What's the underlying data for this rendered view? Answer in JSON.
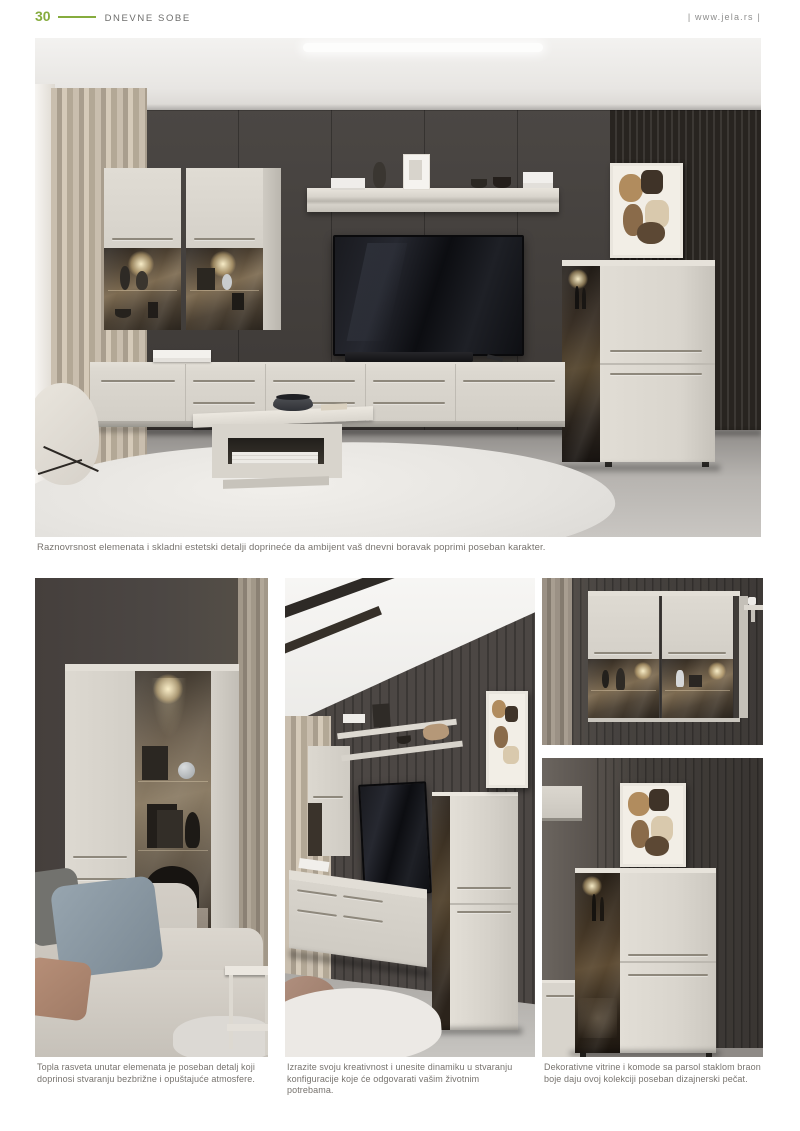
{
  "header": {
    "page_number": "30",
    "section_title": "DNEVNE SOBE",
    "website": "| www.jela.rs |"
  },
  "captions": {
    "main": "Raznovrsnost elemenata i skladni estetski detalji doprineće da ambijent vaš dnevni boravak poprimi poseban karakter.",
    "bottom_left": "Topla rasveta unutar elemenata je poseban detalj koji doprinosi stvaranju bezbrižne i opuštajuće atmosfere.",
    "bottom_middle": "Izrazite svoju kreativnost i unesite dinamiku u stvaranju konfiguracije koje će odgovarati vašim životnim potrebama.",
    "bottom_right": "Dekorativne vitrine i komode sa parsol staklom braon boje daju ovoj kolekciji poseban dizajnerski pečat."
  },
  "colors": {
    "accent_green": "#86ac3e",
    "header_text_gray": "#6d6d6c",
    "caption_gray": "#77736e"
  }
}
